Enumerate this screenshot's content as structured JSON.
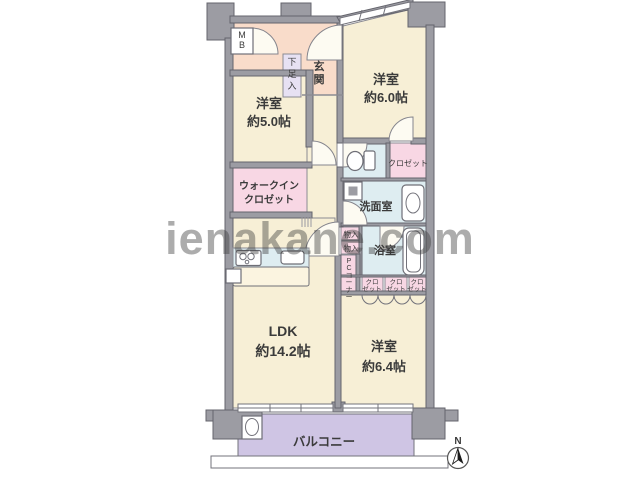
{
  "watermark": "ienakane.com",
  "compass": {
    "north": "N"
  },
  "rooms": {
    "bedroom_top": {
      "name": "洋室",
      "size": "約6.0帖"
    },
    "bedroom_left": {
      "name": "洋室",
      "size": "約5.0帖"
    },
    "bedroom_bottom": {
      "name": "洋室",
      "size": "約6.4帖"
    },
    "ldk": {
      "name": "LDK",
      "size": "約14.2帖"
    },
    "walk_in_closet": {
      "line1": "ウォークイン",
      "line2": "クロゼット"
    },
    "entrance": {
      "label": "玄関"
    },
    "shoe_cabinet": {
      "label": "下足入"
    },
    "meter_box": {
      "label": "MB"
    },
    "closet_top": {
      "label": "クロゼット"
    },
    "washroom": {
      "label": "洗面室"
    },
    "bathroom": {
      "label": "浴室"
    },
    "storage_a": {
      "label": "物入"
    },
    "storage_b": {
      "label": "物入"
    },
    "pc_corner": {
      "label": "PCコーナー"
    },
    "closets_row": [
      {
        "line1": "クロ",
        "line2": "ゼット"
      },
      {
        "line1": "クロ",
        "line2": "ゼット"
      },
      {
        "line1": "クロ",
        "line2": "ゼット"
      }
    ],
    "balcony": {
      "label": "バルコニー"
    }
  },
  "colors": {
    "wall": "#9c9ca3",
    "room_cream": "#f7efd6",
    "entrance_salmon": "#f9dcca",
    "closet_pink": "#f8d7e4",
    "wet_blue": "#deedf1",
    "shoe_lavender": "#e7e1f3",
    "balcony_purple": "#cfc5e4",
    "watermark_grey": "#9e9e9e",
    "text": "#3b3b3b"
  }
}
